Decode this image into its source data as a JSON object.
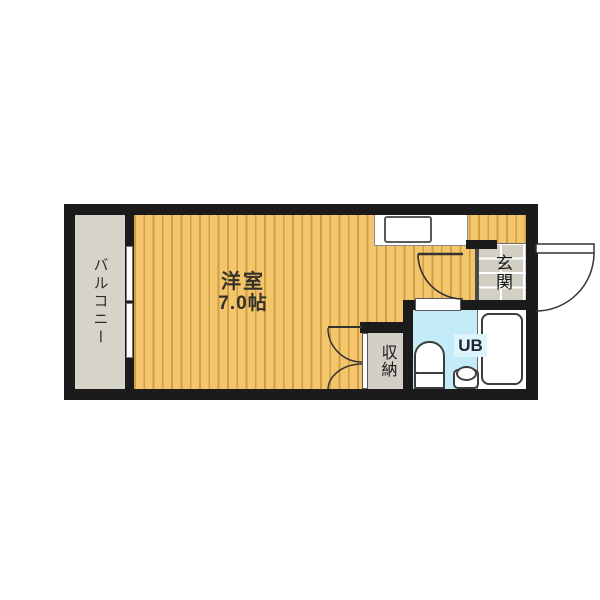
{
  "plan": {
    "title": "studio-apartment-floor-plan",
    "rooms": {
      "balcony": {
        "label": "バルコニー"
      },
      "main_room": {
        "label": "洋室",
        "size": "7.0帖"
      },
      "closet": {
        "label": "収納"
      },
      "entrance": {
        "label": "玄関"
      },
      "unit_bath": {
        "label": "UB"
      }
    },
    "colors": {
      "wall": "#1b1b1b",
      "flooring_light": "#f4c66c",
      "flooring_stripe": "#cf9f44",
      "balcony": "#d6d3c9",
      "entrance_tile": "#d2cfc4",
      "bath": "#c3ebf8",
      "bath_label_bg": "#dcf4fb",
      "fixture_outline": "#3d3d3d",
      "background": "#ffffff"
    }
  }
}
